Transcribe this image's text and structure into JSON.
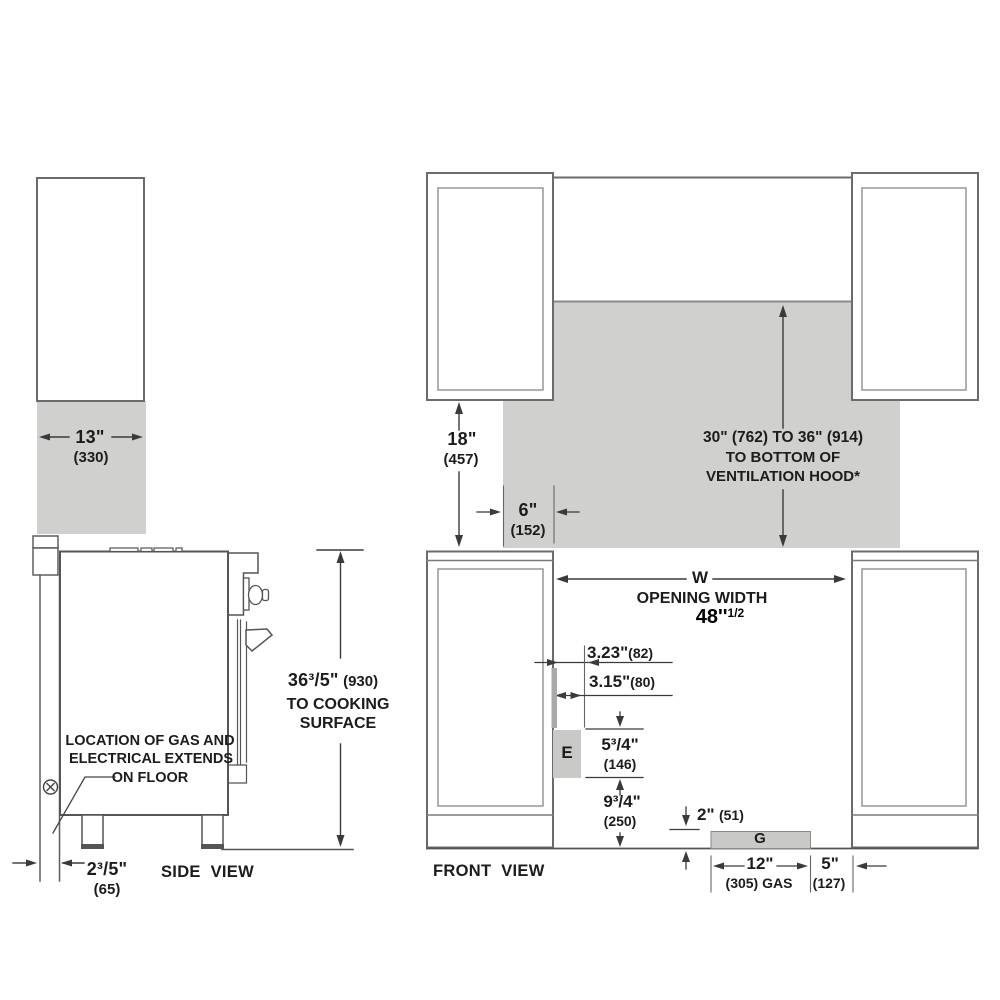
{
  "title": "Range installation dimensions diagram",
  "colors": {
    "shaded_area": "#d0d0ce",
    "box_fill": "#c9c9c7",
    "structure_line": "#6b6b6b",
    "dimension_line": "#3a3a3a",
    "text": "#1c1c1c",
    "highlight_text": "#000000"
  },
  "side_view": {
    "label": "SIDE VIEW",
    "cabinet_width": {
      "main": "13\"",
      "mm": "(330)"
    },
    "cooking_height": {
      "main": "36³/5\"",
      "mm": "(930)",
      "line2": "TO COOKING",
      "line3": "SURFACE"
    },
    "gas_note": {
      "line1": "LOCATION OF GAS AND",
      "line2": "ELECTRICAL EXTENDS",
      "line3": "ON FLOOR"
    },
    "wall_clearance": {
      "main": "2³/5\"",
      "mm": "(65)"
    }
  },
  "front_view": {
    "label": "FRONT VIEW",
    "cabinet_depth": {
      "main": "18\"",
      "mm": "(457)"
    },
    "hood_clearance": {
      "line1": "30\" (762) TO 36\" (914)",
      "line2": "TO BOTTOM OF",
      "line3": "VENTILATION HOOD*"
    },
    "side_clearance": {
      "main": "6\"",
      "mm": "(152)"
    },
    "opening": {
      "symbol": "W",
      "label": "OPENING WIDTH",
      "value": "48''",
      "fraction": "1/2"
    },
    "electrical_offset_a": {
      "main": "3.23\"",
      "mm": "(82)"
    },
    "electrical_offset_b": {
      "main": "3.15\"",
      "mm": "(80)"
    },
    "electrical_box": {
      "label": "E",
      "height": {
        "main": "5³/4\"",
        "mm": "(146)"
      },
      "floor_distance": {
        "main": "9³/4\"",
        "mm": "(250)"
      }
    },
    "gas_box": {
      "label": "G",
      "height": {
        "main": "2\"",
        "mm": "(51)"
      },
      "width": {
        "main": "12\"",
        "mm": "(305) GAS"
      },
      "offset": {
        "main": "5\"",
        "mm": "(127)"
      }
    }
  }
}
